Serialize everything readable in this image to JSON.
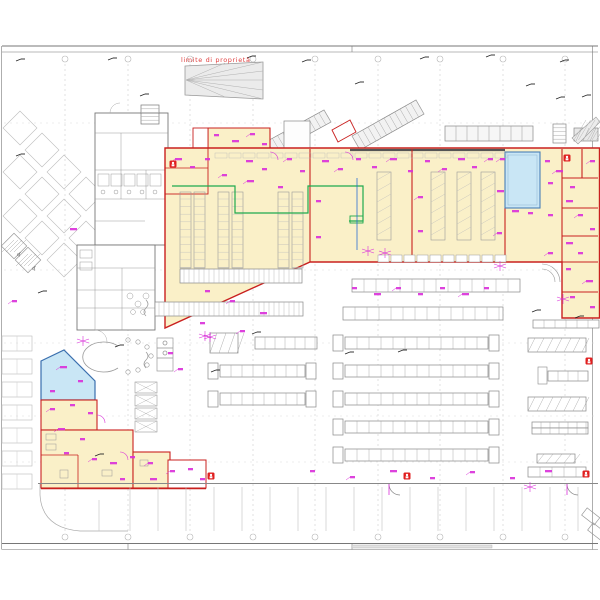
{
  "annotations": {
    "property_line_label": "limite di proprietà"
  },
  "icons": {
    "accessible_parking": "♿",
    "fire_extinguisher": "extinguisher-marker"
  },
  "colors": {
    "wall_red": "#c9201f",
    "hall_fill": "#faf0c8",
    "water_fill": "#c9e6f5",
    "water_stroke": "#4a7fb5",
    "annotation_magenta": "#d92ed9",
    "conduit_green": "#1faa4e",
    "conduit_blue": "#2b6fd4",
    "structure_gray": "#8a8a8a",
    "grid_gray": "#cccccc",
    "label_red": "#e04040",
    "extinguisher_red": "#e02020"
  },
  "fire_extinguisher_positions": [
    [
      173,
      164
    ],
    [
      567,
      158
    ],
    [
      589,
      361
    ],
    [
      211,
      476
    ],
    [
      407,
      476
    ],
    [
      586,
      474
    ]
  ]
}
